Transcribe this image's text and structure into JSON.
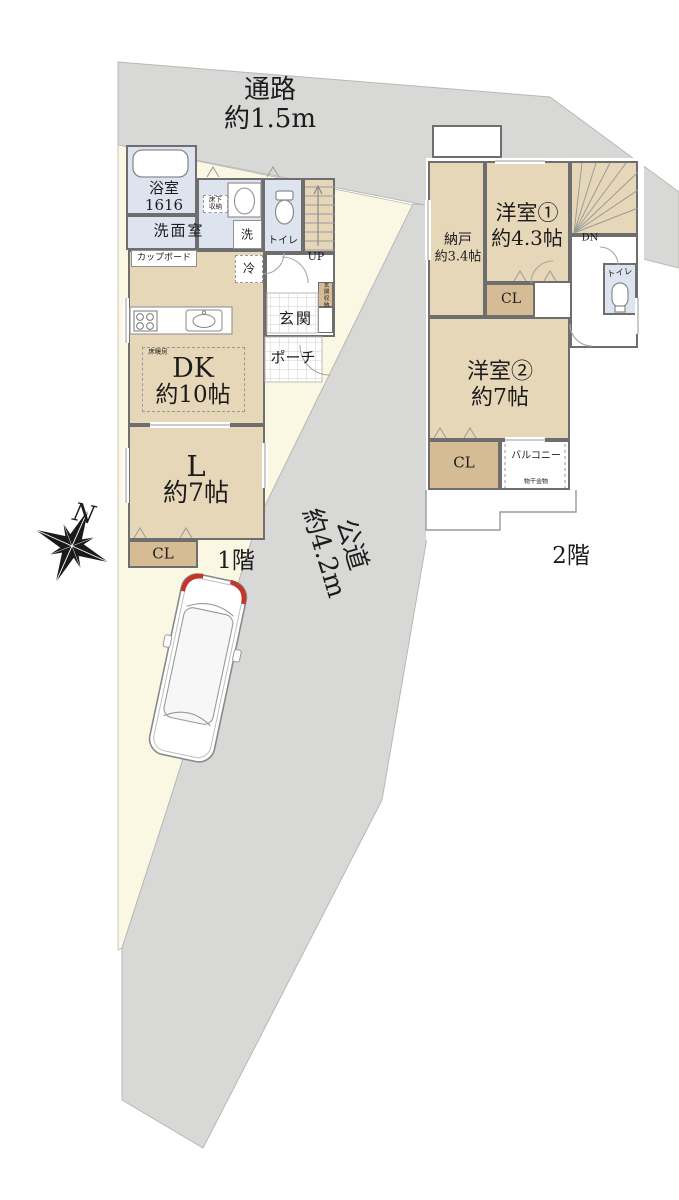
{
  "site": {
    "north": "N",
    "passage_label": "通路\n約1.5m",
    "road_label": "公道\n約4.2m",
    "floor1_tag": "1階",
    "floor2_tag": "2階"
  },
  "floor1": {
    "bath": "浴室\n1616",
    "washroom": "洗面室",
    "washer": "洗",
    "toilet": "トイレ",
    "stairs_up": "UP",
    "underfloor_storage": "床下\n収納",
    "cupboard": "カップボード",
    "fridge": "冷",
    "entrance": "玄関",
    "entrance_storage": "玄関収納",
    "porch": "ポーチ",
    "floor_heating": "床暖房",
    "dining_kitchen": "DK",
    "dining_kitchen_size": "約10帖",
    "living": "L",
    "living_size": "約7帖",
    "closet": "CL"
  },
  "floor2": {
    "storage": "納戸",
    "storage_size": "約3.4帖",
    "bedroom1": "洋室①",
    "bedroom1_size": "約4.3帖",
    "stairs_down": "DN",
    "toilet": "トイレ",
    "closet_a": "CL",
    "bedroom2": "洋室②",
    "bedroom2_size": "約7帖",
    "closet_b": "CL",
    "balcony": "バルコニー",
    "laundry_hardware": "物干金物"
  },
  "icons": {
    "compass": "compass-rose",
    "car": "car-top-view",
    "toilet": "toilet-bowl",
    "bathtub": "bathtub",
    "stove": "gas-stove",
    "sink": "kitchen-sink"
  },
  "colors": {
    "road": "#d8d8d6",
    "road_edge": "#b8b8b4",
    "lot": "#faf8e3",
    "room": "#e7d7b9",
    "closet": "#d5bc94",
    "wet": "#dee4ef",
    "wall": "#6e6e6e",
    "line": "#9a9a9a",
    "grid": "#cfcfcf",
    "accent_red": "#c23528",
    "text": "#1c1c1c"
  }
}
